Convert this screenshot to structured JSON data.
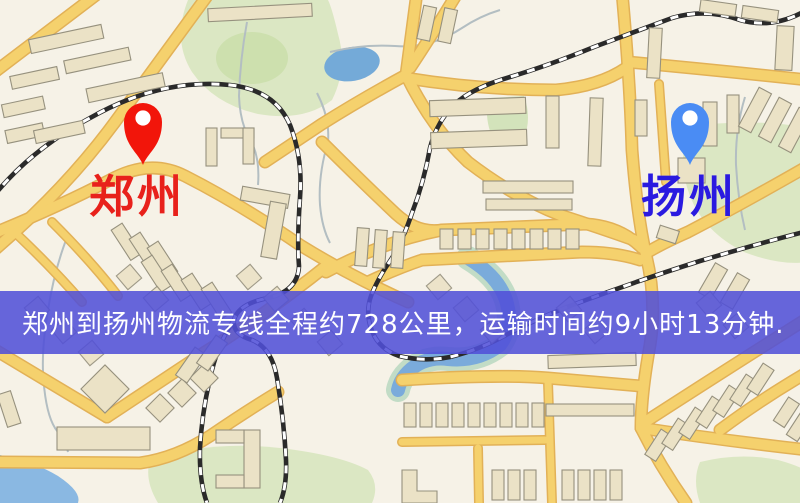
{
  "map": {
    "type": "logistics-route-map",
    "origin": {
      "name": "郑州",
      "pin_color": "#f2150a",
      "label_color": "#e8211b"
    },
    "destination": {
      "name": "扬州",
      "pin_color": "#4a8cf4",
      "label_color": "#2a1ae0"
    },
    "banner": {
      "text": "郑州到扬州物流专线全程约728公里，运输时间约9小时13分钟.",
      "background": "#504fd8",
      "text_color": "#ffffff",
      "distance_km": 728,
      "duration": "9小时13分钟"
    },
    "legend_colors": {
      "land": "#f6f2e7",
      "road": "#f5d16d",
      "road_edge": "#e2b157",
      "water": "#74aad8",
      "park": "#dbe7c3",
      "building": "#ebe2c6",
      "railway": "#2a2a2a"
    }
  }
}
